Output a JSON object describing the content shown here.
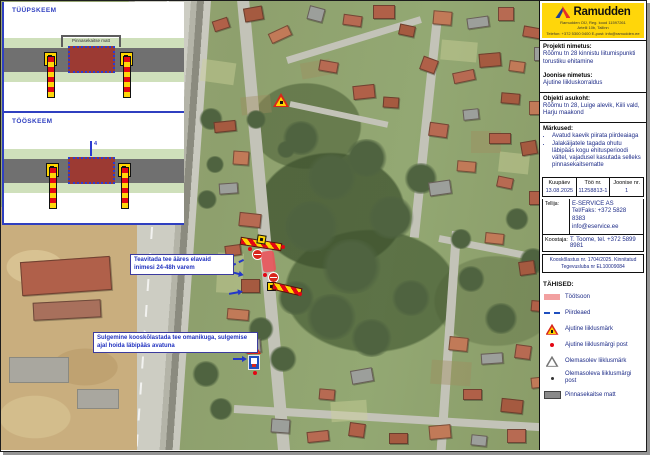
{
  "logo": {
    "brand": "Ramudden",
    "address_lines": [
      "Ramudden OÜ, Reg. kood 11597261",
      "Artelli 10b, Tallinn",
      "Telefon: +372 5300 0400  E-post: info@ramudden.ee"
    ]
  },
  "project": {
    "label": "Projekti nimetus:",
    "value": "Rõõmu tn 28 kinnistu liitumispunkti torustiku ehitamine"
  },
  "drawing": {
    "label": "Joonise nimetus:",
    "value": "Ajutine liikluskorraldus"
  },
  "location": {
    "label": "Objekti asukoht:",
    "value": "Rõõmu tn 28, Luige alevik, Kiili vald, Harju maakond"
  },
  "notes": {
    "label": "Märkused:",
    "items": [
      "Avatud kaevik piirata piirdeaiaga",
      "Jalakäijatele tagada ohutu läbipääs kogu ehitusperioodi vältel, vajadusel kasutada selleks pinnasekaitsematte"
    ]
  },
  "meta": {
    "columns": [
      {
        "label": "Kuupäev",
        "value": "13.08.2025"
      },
      {
        "label": "Töö nr.",
        "value": "11258813-1"
      },
      {
        "label": "Joonise nr.",
        "value": "1"
      }
    ]
  },
  "client": {
    "label": "Tellija:",
    "lines": [
      "E-SERVICE AS",
      "Tel/Faks: +372 5828 8383",
      "info@eservice.ee"
    ]
  },
  "author": {
    "label": "Koostaja:",
    "value": "T. Toome, tel. +372 5899 8981"
  },
  "approval": {
    "line1": "Kooskõlastus nr. 1704/2025. Kinnitatud",
    "line2": "Tegevusluba nr EL10009084"
  },
  "legend": {
    "title": "TÄHISED:",
    "items": [
      {
        "icon": "workzone-swatch",
        "label": "Töötsoon"
      },
      {
        "icon": "fence-swatch",
        "label": "Piirdeaed"
      },
      {
        "icon": "temp-sign-icon",
        "label": "Ajutine liiklusmärk"
      },
      {
        "icon": "temp-post-icon",
        "label": "Ajutine liiklusmärgi post"
      },
      {
        "icon": "existing-sign-icon",
        "label": "Olemasolev liiklusmärk"
      },
      {
        "icon": "existing-post-icon",
        "label": "Olemasoleva liiklusmärgi post"
      },
      {
        "icon": "mat-swatch",
        "label": "Pinnasekaitse matt"
      }
    ]
  },
  "schemes": [
    {
      "title": "TÜÜPSKEEM",
      "mat_label": "Pinnasekaitse matt"
    },
    {
      "title": "TÖÖSKEEM",
      "dim_label": "4"
    }
  ],
  "map_notes": [
    {
      "text": "Teavitada tee ääres elavaid inimesi 24-48h varem"
    },
    {
      "text": "Sulgemine kooskõlastada tee omanikuga, sulgemise ajal hoida läbipääs avatuna"
    }
  ],
  "colors": {
    "brand_yellow": "#FFD60A",
    "sign_red": "#E30613",
    "sign_yellow": "#FFD500",
    "workzone_pink": "#F2A0A0",
    "annotation_blue": "#2438C8"
  }
}
